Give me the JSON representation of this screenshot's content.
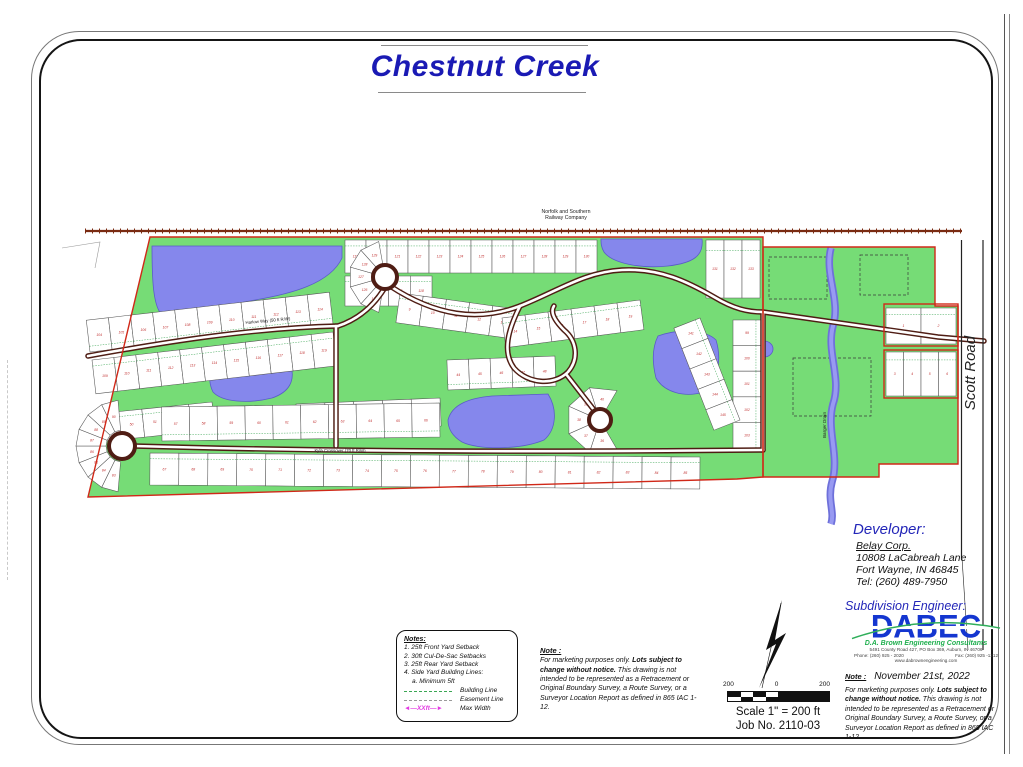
{
  "title": {
    "text": "Chestnut Creek"
  },
  "map": {
    "railway": {
      "line1": "Norfolk and Southern",
      "line2": "Railway Company"
    },
    "labels": {
      "scott_road": "Scott Road",
      "barger_drain": "Barger Drain",
      "harlow": "Harlow Way (50 ft R/W)",
      "kyla": "Kyla Crossover (70 ft R/W)"
    },
    "colors": {
      "land": "#76dc76",
      "water": "#8587ec",
      "boundary": "#d02818",
      "road": "#4f1d14",
      "lot_number": "#c03030",
      "building_line": "#3aa653"
    },
    "lot_strips": [
      {
        "x1": 345,
        "y1": 240,
        "x2": 597,
        "y2": 240,
        "d": -33,
        "n": 12,
        "s": 119
      },
      {
        "x1": 345,
        "y1": 276,
        "x2": 432,
        "y2": 276,
        "d": -30,
        "n": 4,
        "s": 115
      },
      {
        "x1": 706,
        "y1": 240,
        "x2": 760,
        "y2": 240,
        "d": -58,
        "n": 3,
        "s": 131
      },
      {
        "x1": 400,
        "y1": 293,
        "x2": 516,
        "y2": 309,
        "d": -30,
        "n": 5,
        "s": 9
      },
      {
        "x1": 90,
        "y1": 352,
        "x2": 333,
        "y2": 324,
        "d": 32,
        "n": 11,
        "s": 104
      },
      {
        "x1": 92,
        "y1": 360,
        "x2": 333,
        "y2": 332,
        "d": -34,
        "n": 11,
        "s": 109
      },
      {
        "x1": 95,
        "y1": 414,
        "x2": 212,
        "y2": 402,
        "d": -28,
        "n": 5,
        "s": 49
      },
      {
        "x1": 296,
        "y1": 404,
        "x2": 440,
        "y2": 398,
        "d": -28,
        "n": 5,
        "s": 52
      },
      {
        "x1": 162,
        "y1": 441,
        "x2": 440,
        "y2": 437,
        "d": 34,
        "n": 10,
        "s": 57
      },
      {
        "x1": 150,
        "y1": 453,
        "x2": 700,
        "y2": 457,
        "d": -32,
        "n": 19,
        "s": 67
      },
      {
        "x1": 761,
        "y1": 320,
        "x2": 761,
        "y2": 448,
        "d": -28,
        "n": 5,
        "s": 99
      },
      {
        "x1": 448,
        "y1": 390,
        "x2": 556,
        "y2": 386,
        "d": 30,
        "n": 5,
        "s": 44
      },
      {
        "x1": 502,
        "y1": 318,
        "x2": 640,
        "y2": 300,
        "d": -30,
        "n": 6,
        "s": 14
      },
      {
        "x1": 700,
        "y1": 318,
        "x2": 740,
        "y2": 420,
        "d": -28,
        "n": 5,
        "s": 141
      },
      {
        "x1": 886,
        "y1": 308,
        "x2": 956,
        "y2": 308,
        "d": -36,
        "n": 2,
        "s": 1
      },
      {
        "x1": 886,
        "y1": 352,
        "x2": 956,
        "y2": 352,
        "d": -44,
        "n": 4,
        "s": 3
      }
    ],
    "wedges": [
      {
        "cx": 122,
        "cy": 446,
        "a0": 95,
        "a1": 265,
        "r0": 16,
        "r1": 46,
        "n": 8,
        "s": 83
      },
      {
        "cx": 385,
        "cy": 277,
        "a0": 100,
        "a1": 260,
        "r0": 14,
        "r1": 36,
        "n": 5,
        "s": 125
      },
      {
        "cx": 600,
        "cy": 420,
        "a0": 60,
        "a1": 300,
        "r0": 12,
        "r1": 34,
        "n": 5,
        "s": 36
      }
    ]
  },
  "notes_box": {
    "heading": "Notes:",
    "items": [
      "1. 25ft Front Yard Setback",
      "2. 30ft Cul-De-Sac Setbacks",
      "3. 25ft Rear Yard Setback",
      "4. Side Yard Building Lines:",
      "a. Minimum 5ft"
    ],
    "legend": [
      {
        "symbol": "",
        "label": "Building Line"
      },
      {
        "symbol": "",
        "label": "Easement Line"
      },
      {
        "symbol": "XXft",
        "label": "Max Width"
      }
    ]
  },
  "note": {
    "heading": "Note :",
    "p1": "For marketing purposes only.",
    "bold": "Lots subject to change without notice.",
    "p2": "This drawing is not intended to be represented as a Retracement or Original Boundary Survey, a Route Survey, or a Surveyor Location Report as defined in 865 IAC 1-12."
  },
  "scalebar": {
    "ticks": [
      "200",
      "0",
      "200"
    ],
    "scale_text": "Scale 1\" = 200 ft",
    "job_text": "Job No. 2110-03"
  },
  "developer": {
    "heading": "Developer:",
    "name": "Belay Corp.",
    "address1": "10808 LaCabreah Lane",
    "address2": "Fort Wayne, IN 46845",
    "tel": "Tel: (260) 489-7950"
  },
  "engineer": {
    "heading": "Subdivision Engineer:",
    "logo_text": "DABEC",
    "tagline": "D.A. Brown Engineering Consultants",
    "address": "5491 County Road 427, PO Box 369, Auburn, IN 46706",
    "phone": "Phone: (260) 925 - 2020",
    "fax": "Fax: (260) 925 -1212",
    "website": "www.dabrownengineering.com",
    "date_heading": "Note :",
    "date": "November 21st, 2022"
  }
}
